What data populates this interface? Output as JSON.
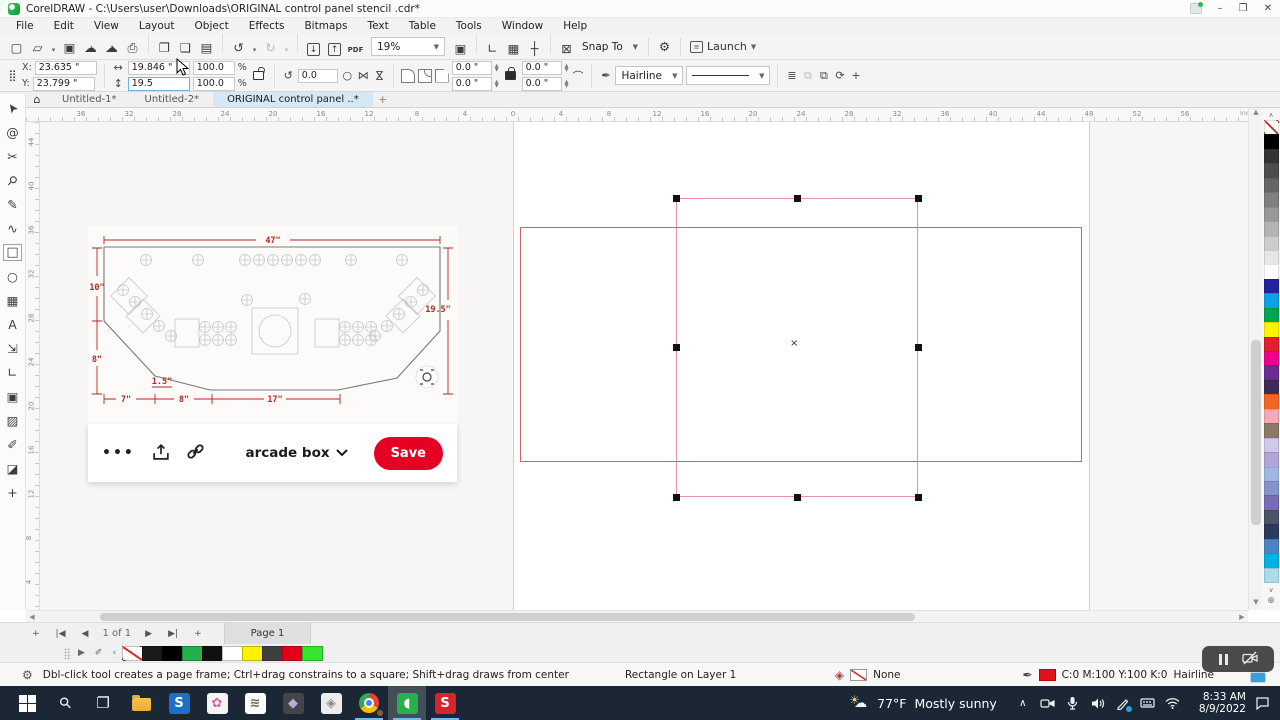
{
  "window": {
    "title": "CorelDRAW - C:\\Users\\user\\Downloads\\ORIGINAL control panel stencil .cdr*"
  },
  "menu": {
    "items": [
      "File",
      "Edit",
      "View",
      "Layout",
      "Object",
      "Effects",
      "Bitmaps",
      "Text",
      "Table",
      "Tools",
      "Window",
      "Help"
    ]
  },
  "toolbar": {
    "zoom_value": "19%",
    "snap_label": "Snap To",
    "launch_label": "Launch",
    "group1": [
      {
        "name": "new-document",
        "glyph": "▢"
      },
      {
        "name": "open",
        "glyph": "▱"
      },
      {
        "name": "open-dropdown",
        "glyph": "▾",
        "dd": true
      },
      {
        "name": "save",
        "glyph": "▣"
      },
      {
        "name": "cloud-download",
        "glyph": "☁",
        "sub": "↓"
      },
      {
        "name": "cloud-upload",
        "glyph": "☁",
        "sub": "↑"
      },
      {
        "name": "print",
        "glyph": "⎙"
      },
      {
        "sep": true
      },
      {
        "name": "copy",
        "glyph": "❐"
      },
      {
        "name": "paste",
        "glyph": "❏"
      },
      {
        "name": "duplicate",
        "glyph": "▤"
      },
      {
        "sep": true
      },
      {
        "name": "undo",
        "glyph": "↺"
      },
      {
        "name": "undo-dropdown",
        "glyph": "▾",
        "dd": true
      },
      {
        "name": "redo",
        "glyph": "↻",
        "disabled": true
      },
      {
        "name": "redo-dropdown",
        "glyph": "▾",
        "dd": true,
        "disabled": true
      },
      {
        "sep": true
      },
      {
        "name": "import",
        "glyph": "↓",
        "boxed": true
      },
      {
        "name": "export",
        "glyph": "↑",
        "boxed": true
      },
      {
        "name": "publish-pdf",
        "glyph": "PDF",
        "pdf": true
      }
    ],
    "group2": [
      {
        "name": "full-screen-preview",
        "glyph": "▣"
      },
      {
        "sep": true
      },
      {
        "name": "show-rulers",
        "glyph": "∟"
      },
      {
        "name": "show-grid",
        "glyph": "▦"
      },
      {
        "name": "show-guidelines",
        "glyph": "┼"
      },
      {
        "sep": true
      },
      {
        "name": "snap-off",
        "glyph": "⊠"
      }
    ],
    "options_glyph": "⚙"
  },
  "property_bar": {
    "x_label": "X:",
    "x_value": "23.635 \"",
    "y_label": "Y:",
    "y_value": "23.799 \"",
    "width_value": "19.846 \"",
    "height_value": "19.5",
    "scale_x": "100.0",
    "scale_y": "100.0",
    "pct": "%",
    "rotation_value": "0.0",
    "corner_tl": "0.0 \"",
    "corner_bl": "0.0 \"",
    "corner_tr": "0.0 \"",
    "corner_br": "0.0 \"",
    "outline_width": "Hairline"
  },
  "document_tabs": {
    "tabs": [
      {
        "label": "Untitled-1*",
        "active": false
      },
      {
        "label": "Untitled-2*",
        "active": false
      },
      {
        "label": "ORIGINAL control panel ..*",
        "active": true
      }
    ]
  },
  "ruler": {
    "units": "inches",
    "h_labels": [
      "36",
      "32",
      "28",
      "24",
      "20",
      "16",
      "12",
      "8",
      "4",
      "0",
      "4",
      "8",
      "12",
      "16",
      "20",
      "24",
      "28",
      "32",
      "36",
      "40",
      "44",
      "48",
      "52",
      "56"
    ],
    "v_labels": [
      "44",
      "40",
      "36",
      "32",
      "28",
      "24",
      "20",
      "16",
      "12",
      "8",
      "4"
    ]
  },
  "toolbox": {
    "tools": [
      {
        "name": "pick-tool",
        "glyph": "➤",
        "rot": -125
      },
      {
        "name": "shape-tool",
        "glyph": "@"
      },
      {
        "name": "crop-tool",
        "glyph": "✂"
      },
      {
        "name": "zoom-tool",
        "glyph": "⚲",
        "rot": 45
      },
      {
        "name": "freehand-tool",
        "glyph": "✎"
      },
      {
        "name": "artistic-media-tool",
        "glyph": "∿"
      },
      {
        "name": "rectangle-tool",
        "glyph": "□",
        "active": true
      },
      {
        "name": "ellipse-tool",
        "glyph": "○"
      },
      {
        "name": "polygon-tool",
        "glyph": "▦"
      },
      {
        "name": "text-tool",
        "glyph": "A"
      },
      {
        "name": "dimension-tool",
        "glyph": "⇲"
      },
      {
        "name": "connector-tool",
        "glyph": "∟"
      },
      {
        "name": "drop-shadow-tool",
        "glyph": "▣"
      },
      {
        "name": "transparency-tool",
        "glyph": "▨"
      },
      {
        "name": "eyedropper-tool",
        "glyph": "✐"
      },
      {
        "name": "interactive-fill-tool",
        "glyph": "◪"
      },
      {
        "name": "add-tools",
        "glyph": "+"
      }
    ]
  },
  "canvas": {
    "center_marker": "×",
    "stencil": {
      "dims": {
        "top": "47\"",
        "left_upper": "10\"",
        "left_lower": "8\"",
        "notch": "1.5\"",
        "bottom_left": "7\"",
        "bottom_mid": "8\"",
        "bottom_span": "17\"",
        "right": "19.5\""
      }
    }
  },
  "pin_overlay": {
    "more_label": "•••",
    "board_label": "arcade box",
    "save_label": "Save",
    "accent": "#e60023"
  },
  "page_nav": {
    "buttons": [
      {
        "name": "add-page-left",
        "glyph": "+"
      },
      {
        "name": "first-page",
        "glyph": "|◀"
      },
      {
        "name": "prev-page",
        "glyph": "◀"
      }
    ],
    "indicator": "1 of 1",
    "buttons_after": [
      {
        "name": "next-page",
        "glyph": "▶"
      },
      {
        "name": "last-page",
        "glyph": "▶|"
      },
      {
        "name": "add-page-right",
        "glyph": "+"
      }
    ],
    "page_tab": "Page 1"
  },
  "document_palette": {
    "flyout_glyph": "▶",
    "eyedropper_glyph": "✐",
    "scroll_left_glyph": "‹",
    "swatches": [
      "none",
      "#1a1a1a",
      "#000000",
      "#22b14c",
      "#101010",
      "#ffffff",
      "#fff200",
      "#3f3f3f",
      "#e2001a",
      "#35e52e"
    ]
  },
  "color_palette": {
    "scroll_up_glyph": "∧",
    "scroll_down_glyph": "∨",
    "options_glyph": "⊕",
    "swatches": [
      "none",
      "#000000",
      "#333333",
      "#4d4d4d",
      "#666666",
      "#808080",
      "#999999",
      "#b3b3b3",
      "#cccccc",
      "#e6e6e6",
      "#ffffff",
      "#23239f",
      "#0aa2e2",
      "#00a651",
      "#fff200",
      "#e31e2d",
      "#ec008c",
      "#682d91",
      "#3f2b56",
      "#f26522",
      "#f6a8b8",
      "#8a7a68",
      "#cfc8ea",
      "#b2a6d6",
      "#9fb8e2",
      "#8494cc",
      "#7a6cb4",
      "#4a5568",
      "#2b3a5e",
      "#4a84c4",
      "#00b2e0",
      "#aadcec"
    ]
  },
  "status_bar": {
    "hint": "Dbl-click tool creates a page frame; Ctrl+drag constrains to a square; Shift+drag draws from center",
    "object_info": "Rectangle on Layer 1",
    "fill_label": "None",
    "outline_values": "C:0 M:100 Y:100 K:0",
    "outline_width": "Hairline"
  },
  "taskbar": {
    "weather_temp": "77°F",
    "weather_desc": "Mostly sunny",
    "clock_time": "8:33 AM",
    "clock_date": "8/9/2022",
    "apps": [
      {
        "name": "start",
        "kind": "start"
      },
      {
        "name": "search",
        "kind": "glyph",
        "glyph": "⚲",
        "rot": -45
      },
      {
        "name": "task-view",
        "kind": "glyph",
        "glyph": "❐"
      },
      {
        "name": "file-explorer",
        "kind": "folder"
      },
      {
        "name": "app-s-blue",
        "kind": "tile",
        "label": "S",
        "tile": "#1d70c4",
        "fg": "#ffffff"
      },
      {
        "name": "app-pink",
        "kind": "tile",
        "label": "✿",
        "tile": "#f4f4f4",
        "fg": "#d86a9e"
      },
      {
        "name": "app-notes",
        "kind": "tile",
        "label": "≋",
        "tile": "#ffffff",
        "fg": "#666666"
      },
      {
        "name": "app-dark",
        "kind": "tile",
        "label": "◆",
        "tile": "#44444c",
        "fg": "#b9a8d8"
      },
      {
        "name": "app-gray",
        "kind": "tile",
        "label": "◈",
        "tile": "#ededed",
        "fg": "#8a8a8a"
      },
      {
        "name": "chrome",
        "kind": "chrome",
        "running": true
      },
      {
        "name": "coreldraw",
        "kind": "tile",
        "label": "◖",
        "tile": "#27b04c",
        "fg": "#ffffff",
        "running": true,
        "active": true
      },
      {
        "name": "app-red-s",
        "kind": "tile",
        "label": "S",
        "tile": "#d5262e",
        "fg": "#ffffff",
        "running": true
      }
    ]
  }
}
